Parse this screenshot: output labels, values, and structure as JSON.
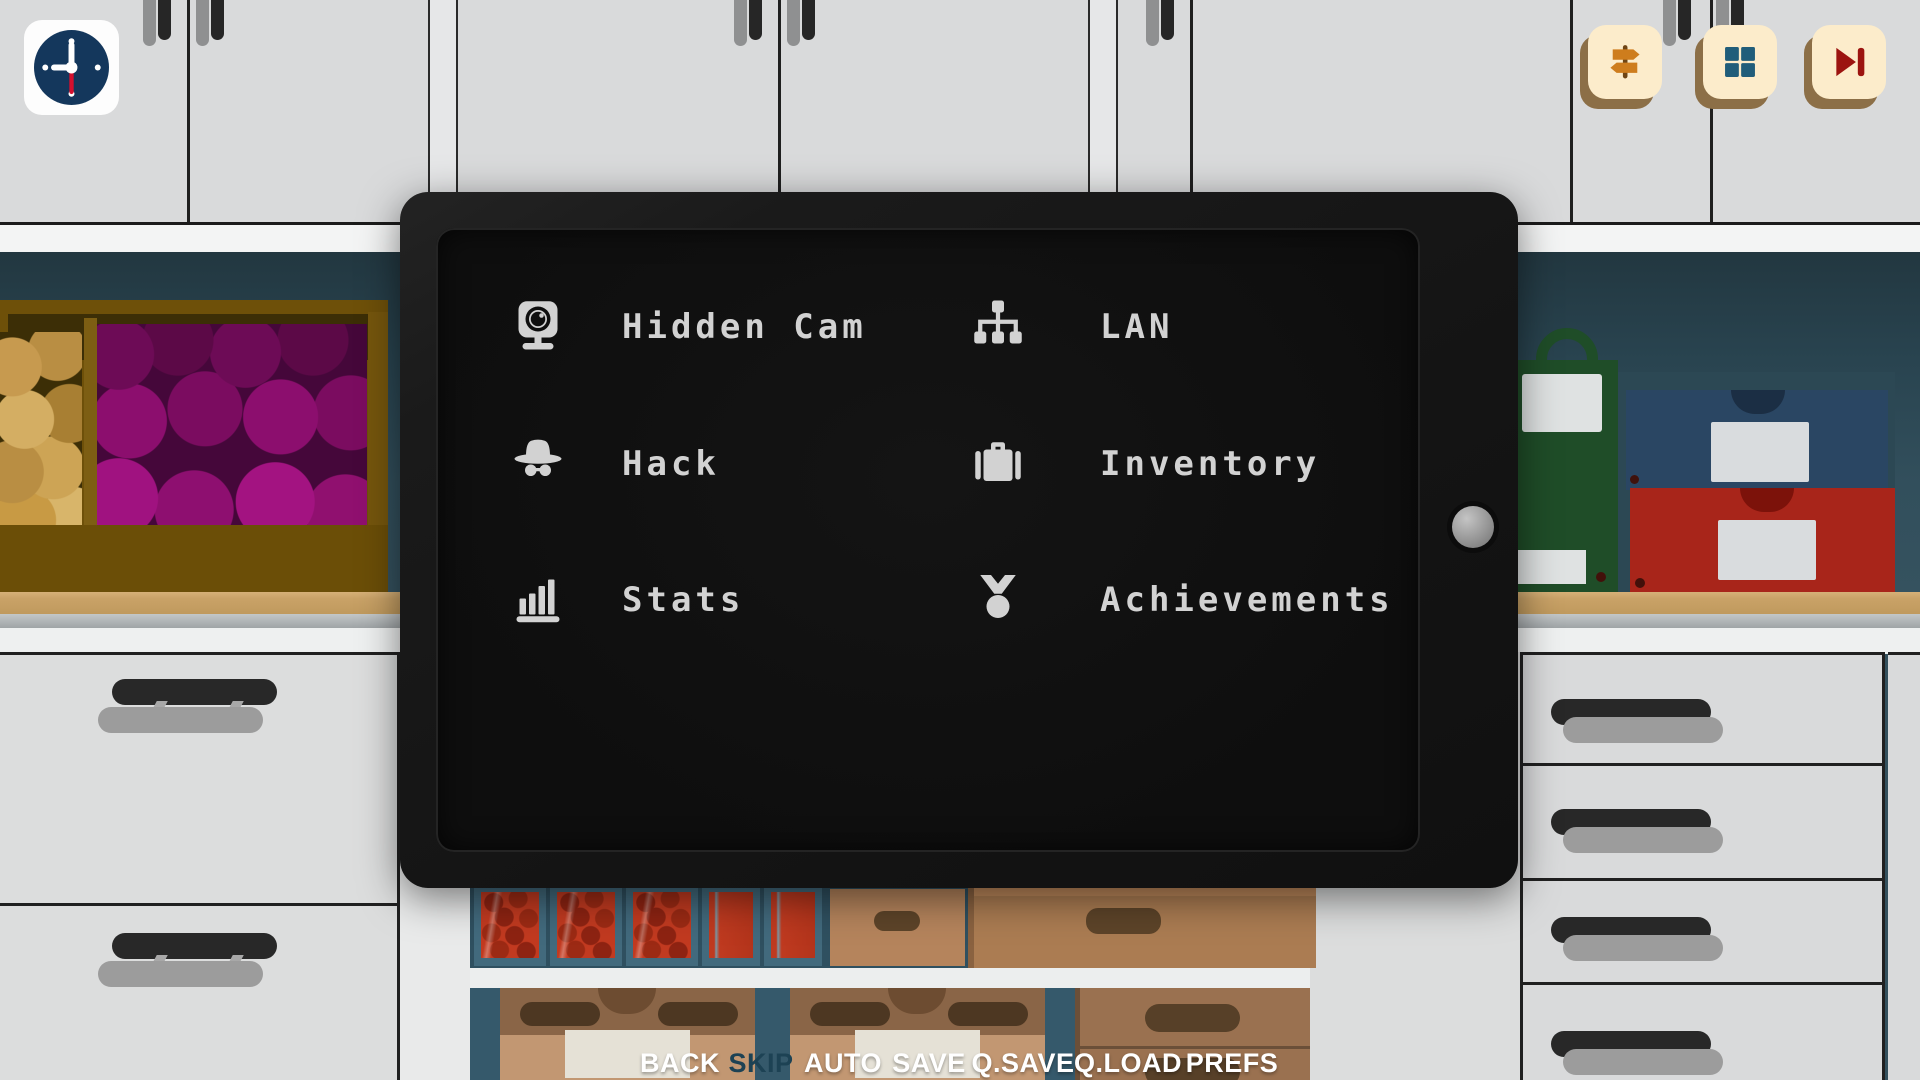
{
  "app": {
    "type": "visual-novel-game",
    "scene": "grocery-storeroom"
  },
  "hud": {
    "clock_button": {
      "icon": "clock-icon"
    },
    "nav_buttons": [
      {
        "name": "map-navigation",
        "icon": "signpost-icon"
      },
      {
        "name": "apps-grid",
        "icon": "grid-icon"
      },
      {
        "name": "skip-forward",
        "icon": "skip-forward-icon"
      }
    ]
  },
  "tablet": {
    "camera": "camera-dot",
    "menu_items": [
      {
        "label": "Hidden Cam",
        "icon": "webcam-icon"
      },
      {
        "label": "Hack",
        "icon": "spy-icon"
      },
      {
        "label": "Stats",
        "icon": "bar-chart-icon"
      },
      {
        "label": "LAN",
        "icon": "network-icon"
      },
      {
        "label": "Inventory",
        "icon": "briefcase-icon"
      },
      {
        "label": "Achievements",
        "icon": "medal-icon"
      }
    ]
  },
  "quick_menu": {
    "items": [
      {
        "label": "BACK",
        "state": "normal"
      },
      {
        "label": "SKIP",
        "state": "active"
      },
      {
        "label": "AUTO",
        "state": "normal"
      },
      {
        "label": "SAVE",
        "state": "normal"
      },
      {
        "label": "Q.SAVE",
        "state": "normal"
      },
      {
        "label": "Q.LOAD",
        "state": "normal"
      },
      {
        "label": "PREFS",
        "state": "normal"
      }
    ],
    "text_color": "#ffffff",
    "active_text_color": "#1d4254"
  },
  "colors": {
    "tablet_body": "#1a1a1a",
    "tablet_screen": "#0e0e0e",
    "tablet_text": "#d2d2d2",
    "wall_teal": "#2c4854",
    "cabinet_gray": "#d9dadb",
    "counter_tan": "#c9a267",
    "hud_button_cream": "#fceccb",
    "hud_button_shadow": "#8c6f47",
    "signpost_orange": "#ce7d1d",
    "grid_teal": "#205d7a",
    "skip_red": "#9c1410",
    "tomato_red": "#c23a20",
    "crate_teal": "#426a7d",
    "box_brown": "#b08257",
    "green_box": "#1f4d28",
    "navy_box": "#2a4663",
    "red_box": "#a8251a"
  }
}
